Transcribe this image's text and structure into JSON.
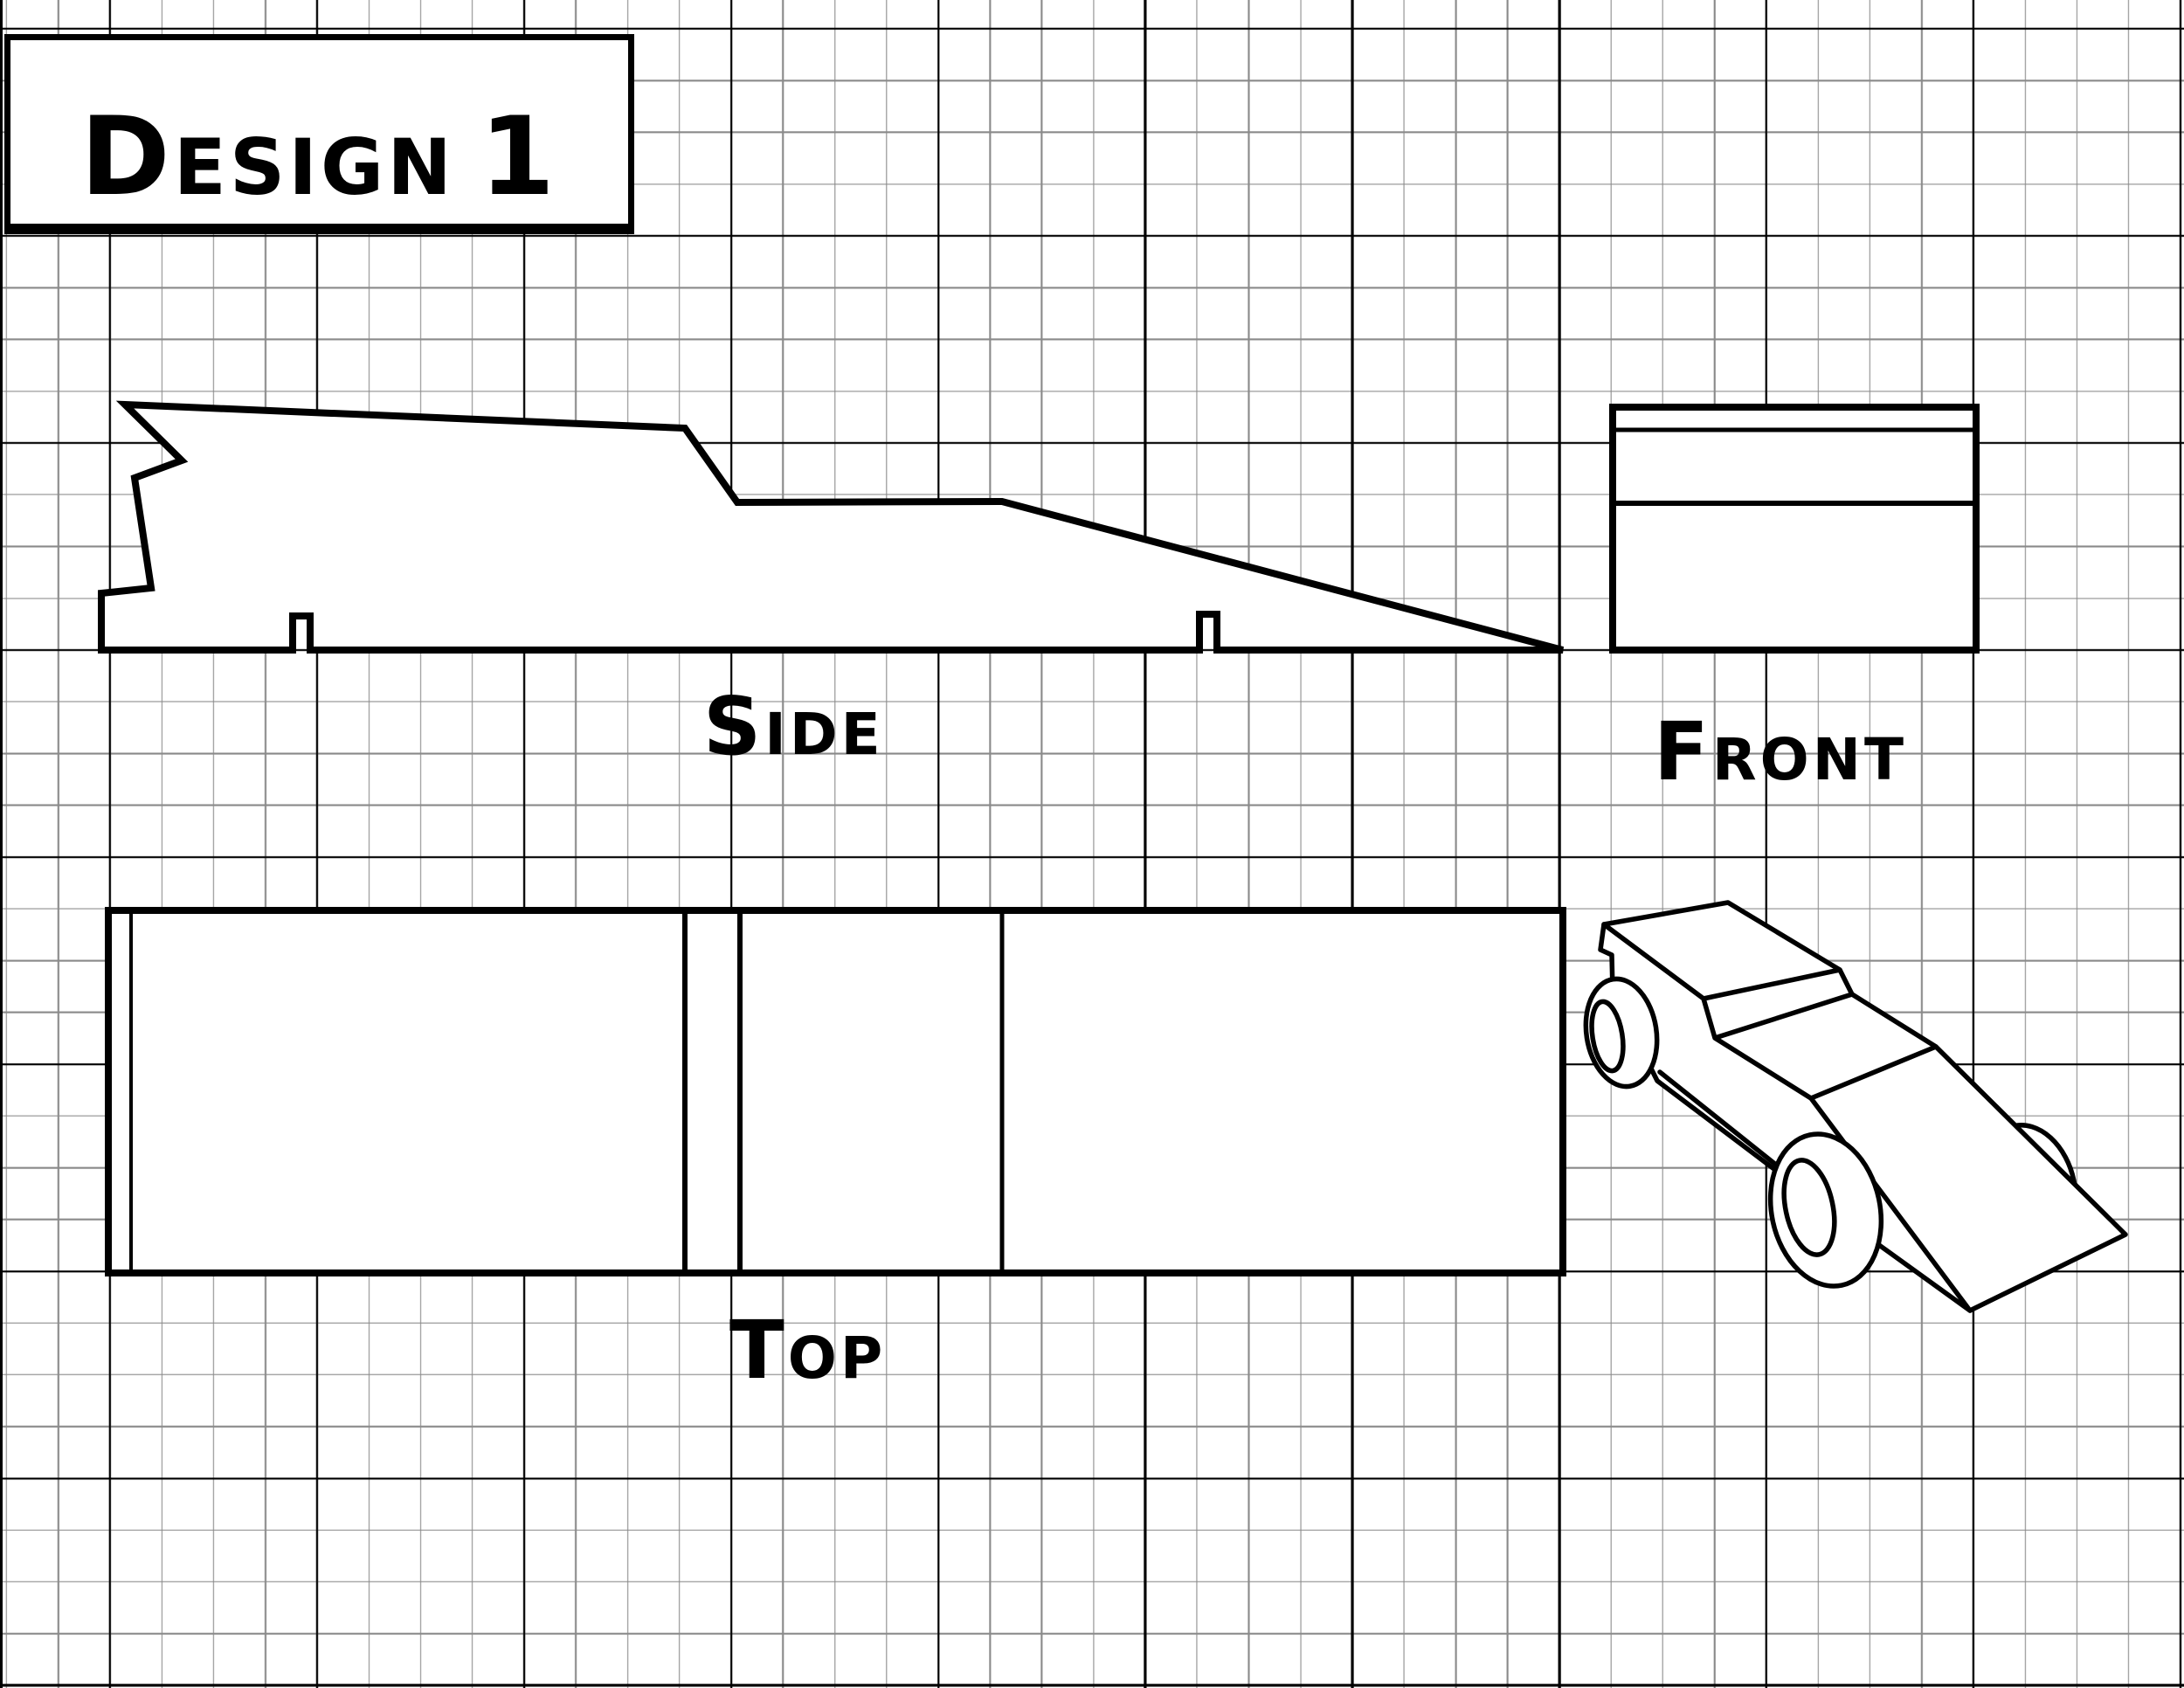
{
  "title_box": {
    "initial": "D",
    "rest": "ESIGN",
    "number": "1"
  },
  "view_labels": {
    "side": {
      "initial": "S",
      "rest": "IDE"
    },
    "front": {
      "initial": "F",
      "rest": "RONT"
    },
    "top": {
      "initial": "T",
      "rest": "OP"
    }
  },
  "views": {
    "side": {
      "features": "wedge profile with rear spoiler notch, two axle slots on bottom edge"
    },
    "front": {
      "features": "rectangle with two horizontal section lines"
    },
    "top": {
      "features": "long rectangle with four vertical section lines"
    },
    "isometric": {
      "features": "3D sketch of car with three visible wheels"
    }
  },
  "colors": {
    "line": "#000000",
    "background": "#ffffff",
    "grid_minor": "#8a8a8a",
    "grid_major": "#000000"
  }
}
